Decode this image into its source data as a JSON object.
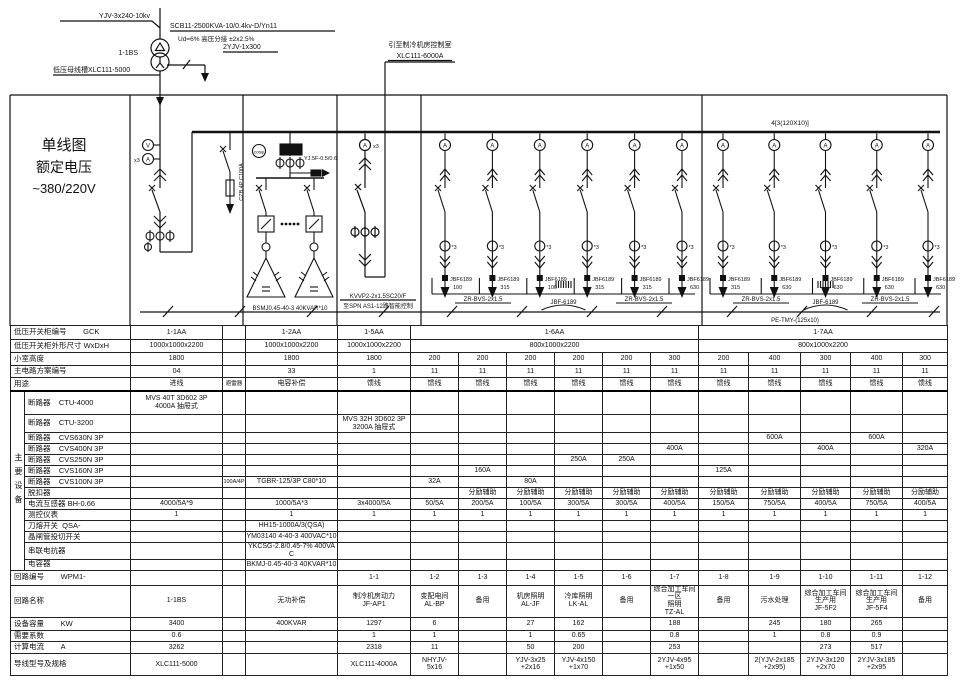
{
  "diagram": {
    "title": [
      "单线图",
      "额定电压",
      "~380/220V"
    ],
    "hv_cable": "YJV-3x240-10kv",
    "transformer_id": "1-1BS",
    "transformer_spec": "SCB11-2500KVA-10/0.4kv-D/Yn11",
    "transformer_spec2": "Ud=6%  高压分接 ±2x2.5%",
    "lv_link": "2YJV-1x300",
    "lv_busway": "低压母线槽XLC111-5000",
    "riser_dest": "引至制冷机房控制室",
    "riser_busway": "XLC111-6000A",
    "arrester_spec": "CZB 4P C100A",
    "cap_ct_label": "YJ.5F-0.5/0.6",
    "cap_bank_label": "BSMJ0.45-40-3 40KVAR*10",
    "aa5_cable": "KVVP2-2x1.5SC20/F",
    "aa5_dest": "至SPN AS1-12路智能控制",
    "bus_label": "4[3(120X10)]",
    "pe_label": "PE-TMY-(125x10)",
    "module_bus_label": "JBF-6189",
    "module_cable": "ZR-BVS-2x1.5",
    "module_model": "JBF6189",
    "meter_v": "V",
    "meter_a": "A",
    "times3": "x3",
    "ct_times3": "*3",
    "cos_phi": "cosφ",
    "groups": [
      {
        "modules": [
          "100",
          "315",
          "100",
          "315",
          "315",
          "630"
        ]
      },
      {
        "modules": [
          "315",
          "630",
          "630",
          "630",
          "630"
        ]
      }
    ]
  },
  "footer": {
    "rs485": "RS485 至后台监控系统"
  },
  "table": {
    "group_label": "主要设备",
    "group_rows": 14,
    "col_widths": [
      92,
      23,
      92,
      73,
      48,
      48,
      48,
      48,
      48,
      48,
      50,
      52,
      50,
      52,
      45
    ],
    "rows": [
      {
        "h": 14,
        "label": "低压开关柜编号        GCK",
        "cells": [
          {
            "t": "1-1AA"
          },
          {
            "t": ""
          },
          {
            "t": "1-2AA"
          },
          {
            "t": "1-5AA"
          },
          {
            "t": "1-6AA",
            "s": 6
          },
          {
            "t": "1-7AA",
            "s": 5
          }
        ]
      },
      {
        "h": 13,
        "label": "低压开关柜外形尺寸 WxDxH",
        "cells": [
          {
            "t": "1000x1000x2200"
          },
          {
            "t": ""
          },
          {
            "t": "1000x1000x2200"
          },
          {
            "t": "1000x1000x2200"
          },
          {
            "t": "800x1000x2200",
            "s": 6
          },
          {
            "t": "800x1000x2200",
            "s": 5
          }
        ]
      },
      {
        "h": 13,
        "label": "小室高度",
        "cells": [
          "1800",
          "",
          "1800",
          "1800",
          "200",
          "200",
          "200",
          "200",
          "200",
          "300",
          "200",
          "400",
          "300",
          "400",
          "300"
        ]
      },
      {
        "h": 12,
        "label": "主电路方案编号",
        "cells": [
          "04",
          "",
          "33",
          "1",
          "11",
          "11",
          "11",
          "11",
          "11",
          "11",
          "11",
          "11",
          "11",
          "11",
          "11"
        ]
      },
      {
        "h": 13,
        "label": "用途",
        "hrule": true,
        "cells": [
          "进线",
          "避雷器",
          "电容补偿",
          "馈线",
          "馈线",
          "馈线",
          "馈线",
          "馈线",
          "馈线",
          "馈线",
          "馈线",
          "馈线",
          "馈线",
          "馈线",
          "馈线"
        ]
      },
      {
        "h": 24,
        "g": 1,
        "gs": 1,
        "label": "断路器    CTU-4000",
        "cells": [
          "MVS 40T 3D602 3P\n4000A 抽屉式",
          "",
          "",
          "",
          "",
          "",
          "",
          "",
          "",
          "",
          "",
          "",
          "",
          "",
          ""
        ]
      },
      {
        "h": 18,
        "g": 1,
        "label": "断路器    CTU-3200",
        "cells": [
          "",
          "",
          "",
          "MVS 32H 3D602 3P\n3200A 抽屉式",
          "",
          "",
          "",
          "",
          "",
          "",
          "",
          "",
          "",
          "",
          ""
        ]
      },
      {
        "h": 11,
        "g": 1,
        "label": "断路器    CVS630N 3P",
        "cells": [
          "",
          "",
          "",
          "",
          "",
          "",
          "",
          "",
          "",
          "",
          "",
          "600A",
          "",
          "600A",
          ""
        ]
      },
      {
        "h": 11,
        "g": 1,
        "label": "断路器    CVS400N 3P",
        "cells": [
          "",
          "",
          "",
          "",
          "",
          "",
          "",
          "",
          "",
          "400A",
          "",
          "",
          "400A",
          "",
          "320A"
        ]
      },
      {
        "h": 11,
        "g": 1,
        "label": "断路器    CVS250N 3P",
        "cells": [
          "",
          "",
          "",
          "",
          "",
          "",
          "",
          "250A",
          "250A",
          "",
          "",
          "",
          "",
          "",
          ""
        ]
      },
      {
        "h": 11,
        "g": 1,
        "label": "断路器    CVS160N 3P",
        "cells": [
          "",
          "",
          "",
          "",
          "",
          "160A",
          "",
          "",
          "",
          "",
          "125A",
          "",
          "",
          "",
          ""
        ]
      },
      {
        "h": 11,
        "g": 1,
        "label": "断路器    CVS100N 3P",
        "cells": [
          "",
          "100A/4P",
          "TGBR-125/3P C80*10",
          "",
          "32A",
          "",
          "80A",
          "",
          "",
          "",
          "",
          "",
          "",
          "",
          ""
        ]
      },
      {
        "h": 11,
        "g": 1,
        "label": "脱扣器",
        "cells": [
          "",
          "",
          "",
          "",
          "",
          "分励辅助",
          "分励辅助",
          "分励辅助",
          "分励辅助",
          "分励辅助",
          "分励辅助",
          "分励辅助",
          "分励辅助",
          "分励辅助",
          "分励辅助"
        ]
      },
      {
        "h": 11,
        "g": 1,
        "label": "电流互感器 BH-0.66",
        "cells": [
          "4000/5A*9",
          "",
          "1000/5A*3",
          "3x4000/5A",
          "50/5A",
          "200/5A",
          "100/5A",
          "300/5A",
          "300/5A",
          "400/5A",
          "150/5A",
          "750/5A",
          "400/5A",
          "750/5A",
          "400/5A"
        ]
      },
      {
        "h": 11,
        "g": 1,
        "label": "测控仪表",
        "cells": [
          "1",
          "",
          "1",
          "1",
          "1",
          "1",
          "1",
          "1",
          "1",
          "1",
          "1",
          "1",
          "1",
          "1",
          "1"
        ]
      },
      {
        "h": 11,
        "g": 1,
        "label": "刀熔开关  QSA-",
        "cells": [
          "",
          "",
          "HH15-1000A/3(QSA)",
          "",
          "",
          "",
          "",
          "",
          "",
          "",
          "",
          "",
          "",
          "",
          ""
        ]
      },
      {
        "h": 11,
        "g": 1,
        "label": "晶闸管投切开关",
        "cells": [
          "",
          "",
          "YM03140 4-40-3 400VAC*10",
          "",
          "",
          "",
          "",
          "",
          "",
          "",
          "",
          "",
          "",
          "",
          ""
        ]
      },
      {
        "h": 11,
        "g": 1,
        "label": "串联电抗器",
        "cells": [
          "",
          "",
          "YKCSG-2.8/0.45-7% 400VAC",
          "",
          "",
          "",
          "",
          "",
          "",
          "",
          "",
          "",
          "",
          "",
          ""
        ]
      },
      {
        "h": 11,
        "g": 1,
        "label": "电容器",
        "cells": [
          "",
          "",
          "BKMJ-0.45-40-3 40KVAR*10",
          "",
          "",
          "",
          "",
          "",
          "",
          "",
          "",
          "",
          "",
          "",
          ""
        ]
      },
      {
        "h": 15,
        "label": "回路编号        WPM1-",
        "cells": [
          "",
          "",
          "",
          "1-1",
          "1-2",
          "1-3",
          "1-4",
          "1-5",
          "1-6",
          "1-7",
          "1-8",
          "1-9",
          "1-10",
          "1-11",
          "1-12"
        ]
      },
      {
        "h": 22,
        "label": "回路名称",
        "cells": [
          "1-1BS",
          "",
          "无功补偿",
          "制冷机房动力\nJF-AP1",
          "变配电间\nAL-BP",
          "备用",
          "机房照明\nAL-JF",
          "冷库照明\nLK-AL",
          "备用",
          "综合加工车间一区\n照明\nTZ-AL",
          "备用",
          "污水处理",
          "综合加工车间\n生产用\nJF-5F2",
          "综合加工车间\n生产用\nJF-5F4",
          "备用"
        ]
      },
      {
        "h": 13,
        "label": "设备容量        KW",
        "cells": [
          "3400",
          "",
          "400KVAR",
          "1297",
          "6",
          "",
          "27",
          "162",
          "",
          "188",
          "",
          "245",
          "180",
          "265",
          ""
        ]
      },
      {
        "h": 11,
        "label": "需要系数",
        "cells": [
          "0.6",
          "",
          "",
          "1",
          "1",
          "",
          "1",
          "0.65",
          "",
          "0.8",
          "",
          "1",
          "0.8",
          "0.9",
          ""
        ]
      },
      {
        "h": 12,
        "label": "计算电流        A",
        "cells": [
          "3262",
          "",
          "",
          "2318",
          "11",
          "",
          "50",
          "200",
          "",
          "253",
          "",
          "",
          "273",
          "517",
          ""
        ]
      },
      {
        "h": 22,
        "label": "导线型号及规格",
        "cells": [
          "XLC111-5000",
          "",
          "",
          "XLC111-4000A",
          "NHYJV-\n5x16",
          "",
          "YJV-3x25\n+2x16",
          "YJV-4x150\n+1x70",
          "",
          "2YJV-4x95\n+1x50",
          "",
          "2(YJV-2x185\n+2x95)",
          "2YJV-3x120\n+2x70",
          "2YJV-3x185\n+2x95",
          ""
        ]
      }
    ]
  }
}
